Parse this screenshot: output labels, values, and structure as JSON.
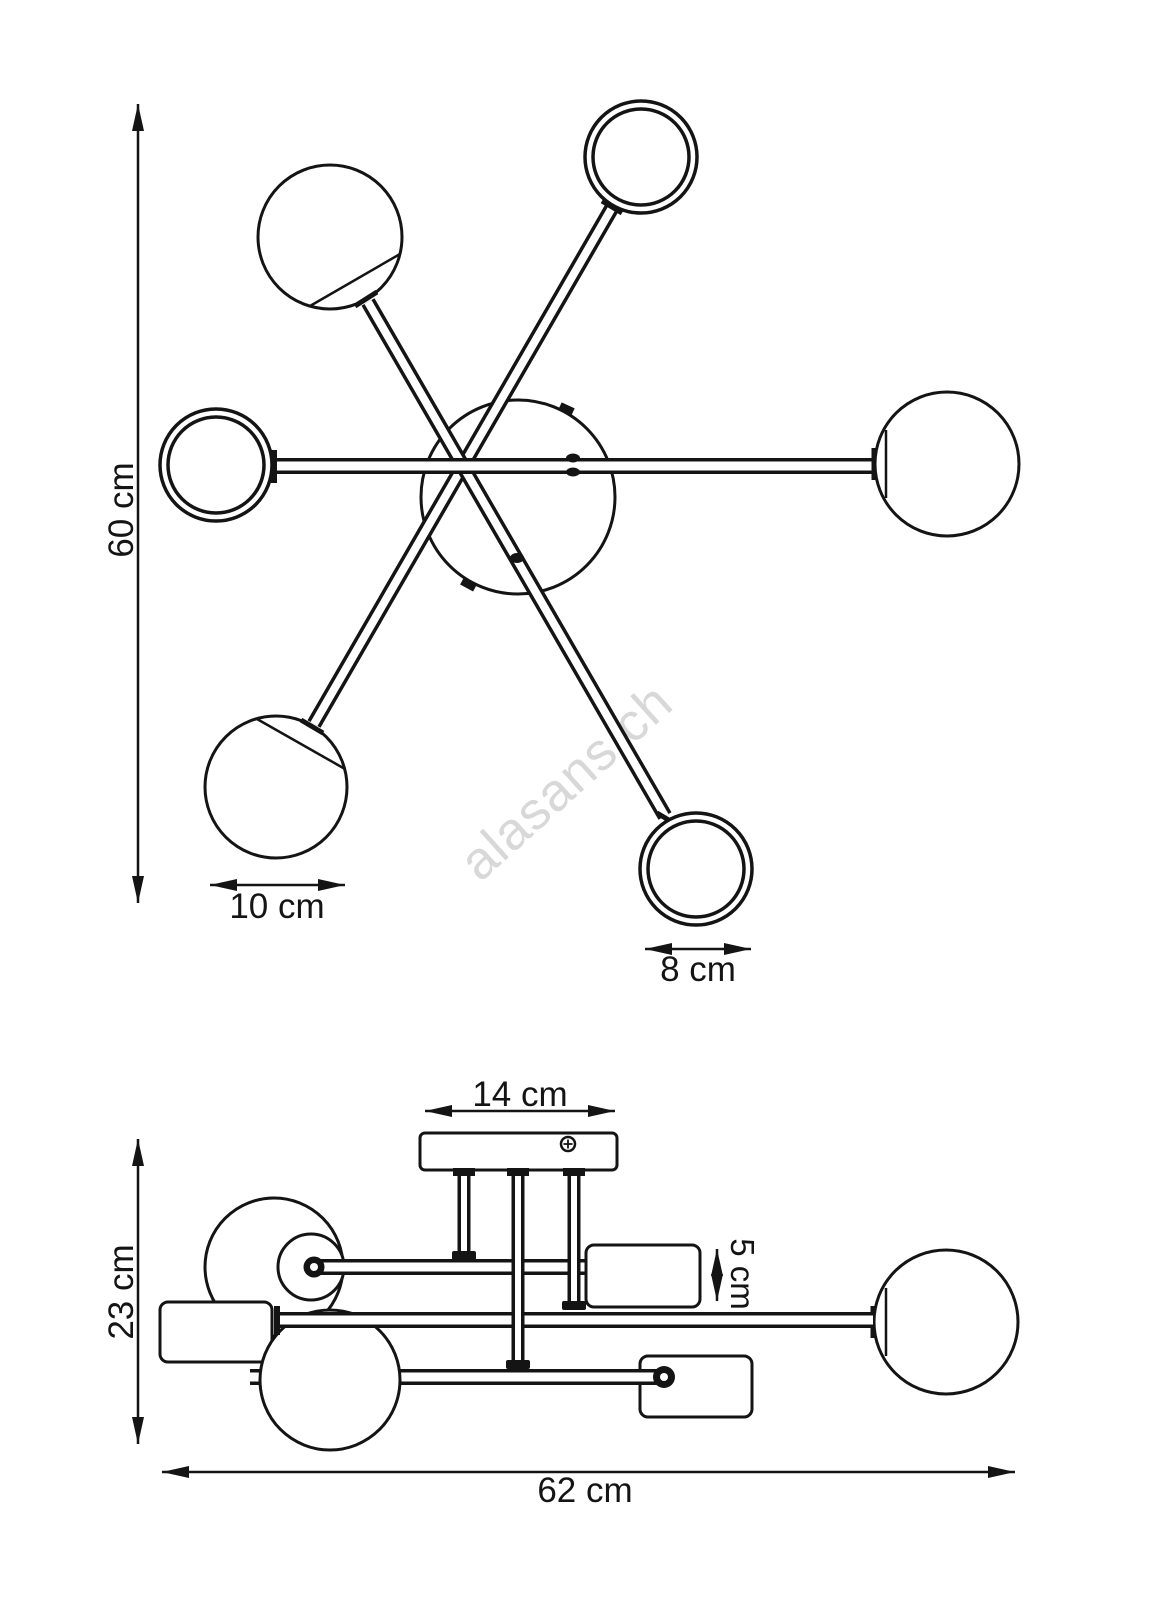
{
  "page": {
    "background_color": "#ffffff",
    "line_color": "#141414",
    "watermark_color": "#d8d8d8"
  },
  "watermark": {
    "text": "alasans.ch"
  },
  "top_view": {
    "description": "ceiling lamp, view from below: central canopy hub with six straight arms ending in 3 glass spheres and 3 open rings",
    "dimensions": {
      "height": "60 cm",
      "sphere_diameter": "10 cm",
      "ring_diameter": "8 cm"
    }
  },
  "side_view": {
    "description": "ceiling lamp, side view: ceiling canopy with three stems carrying staggered horizontal arms, glass spheres and cylindrical shades",
    "dimensions": {
      "canopy_width": "14 cm",
      "shade_height": "5 cm",
      "height": "23 cm",
      "total_width": "62 cm"
    }
  }
}
